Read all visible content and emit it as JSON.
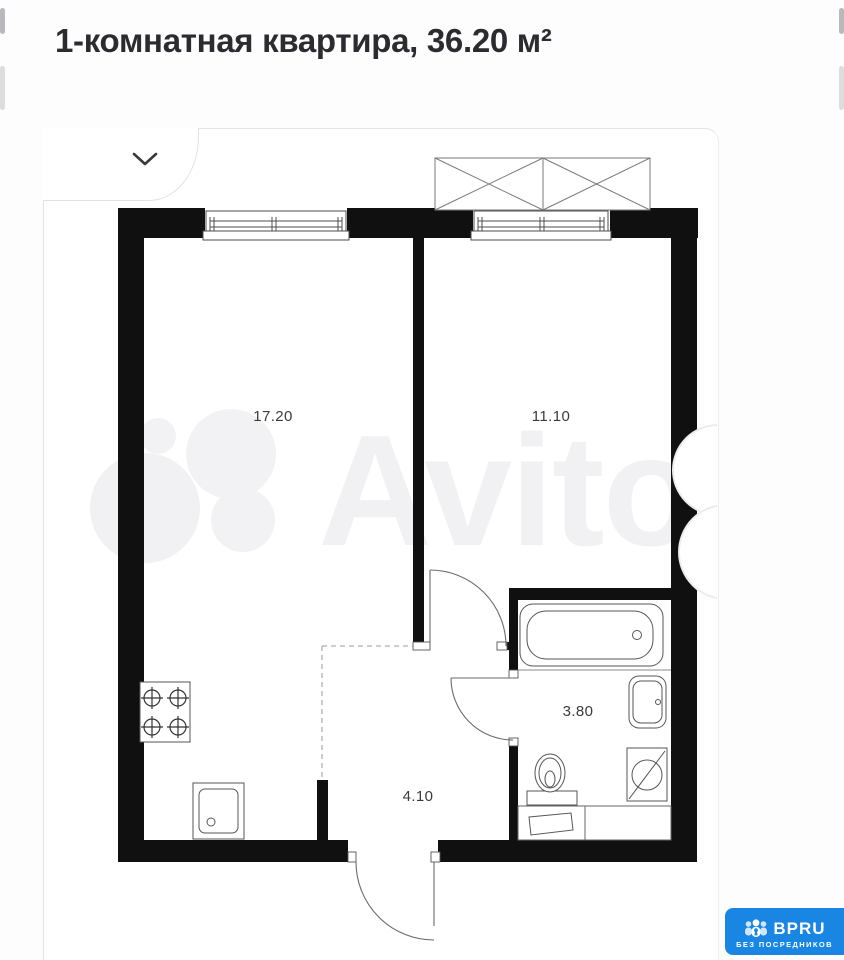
{
  "header": {
    "title": "1-комнатная квартира, 36.20 м²"
  },
  "plan": {
    "rooms": [
      {
        "id": "living-kitchen",
        "area": "17.20"
      },
      {
        "id": "bedroom",
        "area": "11.10"
      },
      {
        "id": "bathroom",
        "area": "3.80"
      },
      {
        "id": "hallway",
        "area": "4.10"
      }
    ],
    "watermark": "Avito",
    "wall_color": "#101010",
    "line_color": "#555555"
  },
  "expander": {
    "icon": "chevron-down"
  },
  "logo": {
    "brand": "BPRU",
    "tagline": "БЕЗ ПОСРЕДНИКОВ",
    "color": "#1a86e3",
    "icon": "people-group"
  }
}
